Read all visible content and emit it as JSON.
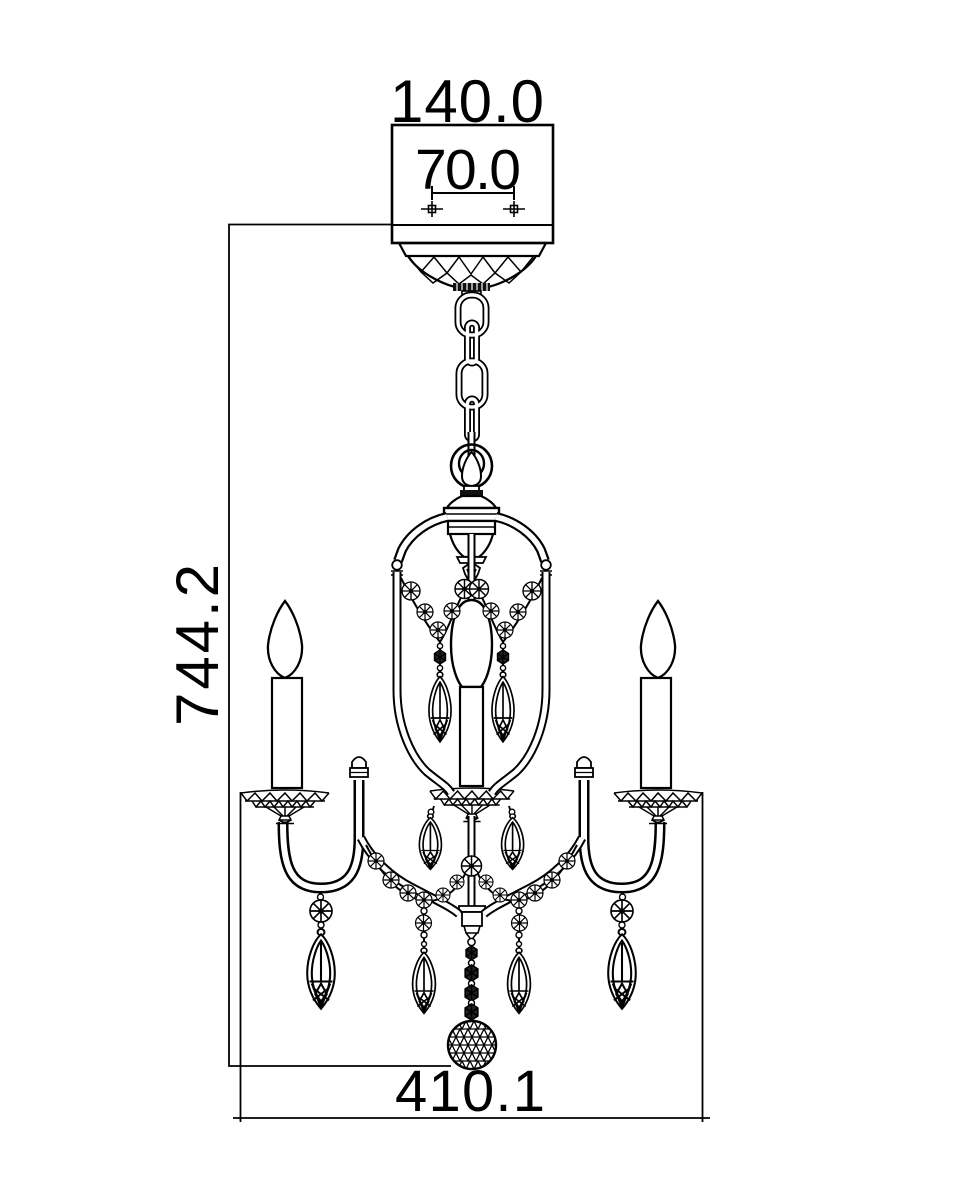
{
  "dimensions": {
    "canopy_width": "140.0",
    "mounting_holes_spacing": "70.0",
    "overall_height": "744.2",
    "overall_width": "410.1"
  },
  "colors": {
    "line": "#000000",
    "background": "#ffffff"
  }
}
